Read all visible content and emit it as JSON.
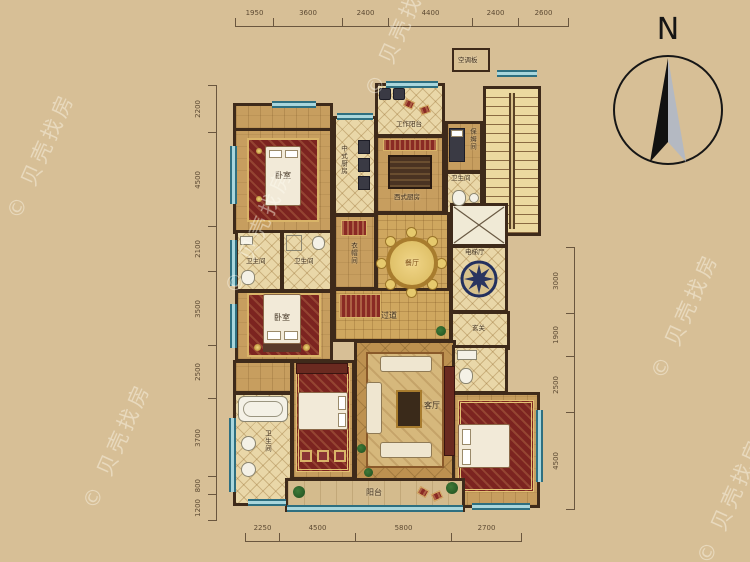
{
  "compass": {
    "north_label": "N"
  },
  "watermark": {
    "text": "© 贝壳找房"
  },
  "dimensions": {
    "top": [
      "1950",
      "3600",
      "2400",
      "4400",
      "2400",
      "2600"
    ],
    "bottom": [
      "2250",
      "4500",
      "5800",
      "2700"
    ],
    "left": [
      "2200",
      "4500",
      "2100",
      "3500",
      "2500",
      "3700",
      "800",
      "1200"
    ],
    "right": [
      "3000",
      "1900",
      "2500",
      "4500"
    ]
  },
  "rooms": {
    "bedroom_top_left": "卧室",
    "chinese_kitchen": "中式厨房",
    "work_balcony": "工作阳台",
    "western_kitchen": "西式厨房",
    "nanny_room": "保姆间",
    "nanny_bathroom": "卫生间",
    "ac_panel": "空调板",
    "cloakroom": "衣帽间",
    "dining_room": "餐厅",
    "elevator_hall": "电梯厅",
    "bathroom_left_1": "卫生间",
    "bathroom_left_2": "卫生间",
    "bedroom_middle": "卧室",
    "corridor": "过道",
    "foyer": "玄关",
    "living_room": "客厅",
    "master_bathroom": "卫生间",
    "balcony": "阳台"
  }
}
